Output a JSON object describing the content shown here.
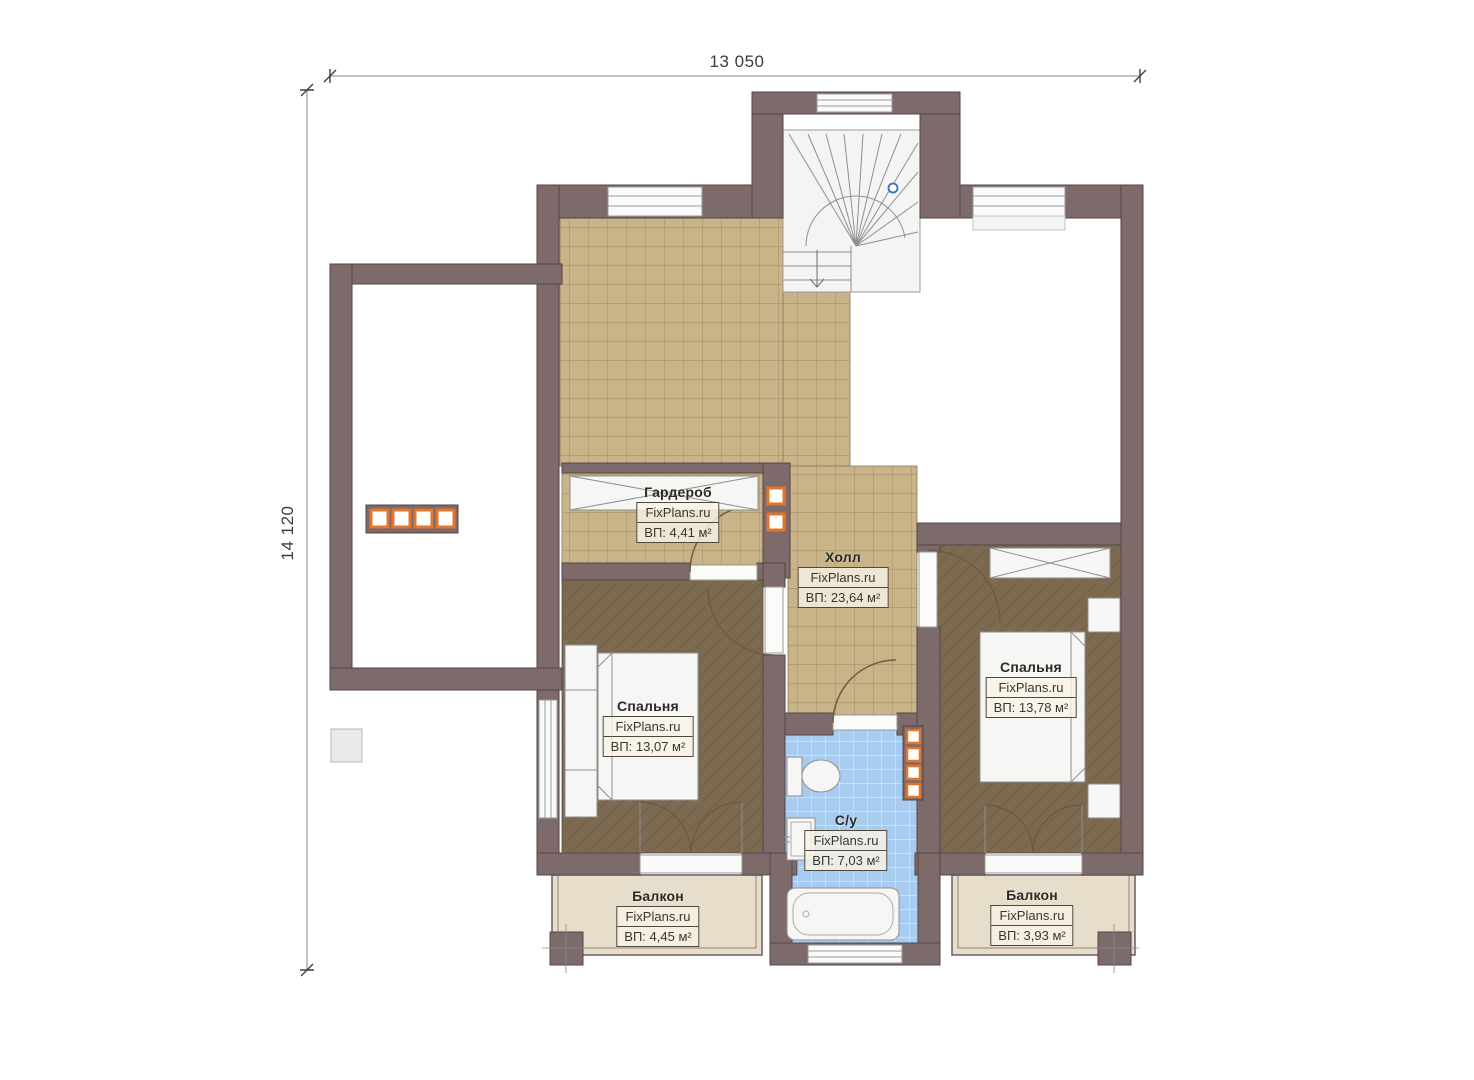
{
  "dimensions": {
    "width_label": "13 050",
    "height_label": "14 120"
  },
  "rooms": [
    {
      "id": "wardrobe",
      "name": "Гардероб",
      "brand": "FixPlans.ru",
      "area_label": "ВП: 4,41 м²"
    },
    {
      "id": "hall",
      "name": "Холл",
      "brand": "FixPlans.ru",
      "area_label": "ВП: 23,64 м²"
    },
    {
      "id": "bedroom-left",
      "name": "Спальня",
      "brand": "FixPlans.ru",
      "area_label": "ВП: 13,07 м²"
    },
    {
      "id": "bedroom-right",
      "name": "Спальня",
      "brand": "FixPlans.ru",
      "area_label": "ВП: 13,78 м²"
    },
    {
      "id": "bathroom",
      "name": "С/у",
      "brand": "FixPlans.ru",
      "area_label": "ВП: 7,03 м²"
    },
    {
      "id": "balcony-left",
      "name": "Балкон",
      "brand": "FixPlans.ru",
      "area_label": "ВП: 4,45 м²"
    },
    {
      "id": "balcony-right",
      "name": "Балкон",
      "brand": "FixPlans.ru",
      "area_label": "ВП: 3,93 м²"
    }
  ],
  "colors": {
    "wall": "#7d6a6b",
    "hall_tile": "#c9b388",
    "bedroom_floor": "#7b6950",
    "bath_tile": "#a8cbf0",
    "balcony_floor": "#e7ddcb",
    "accent_orange": "#e4762b",
    "stair_marker_blue": "#3a6fbd"
  }
}
